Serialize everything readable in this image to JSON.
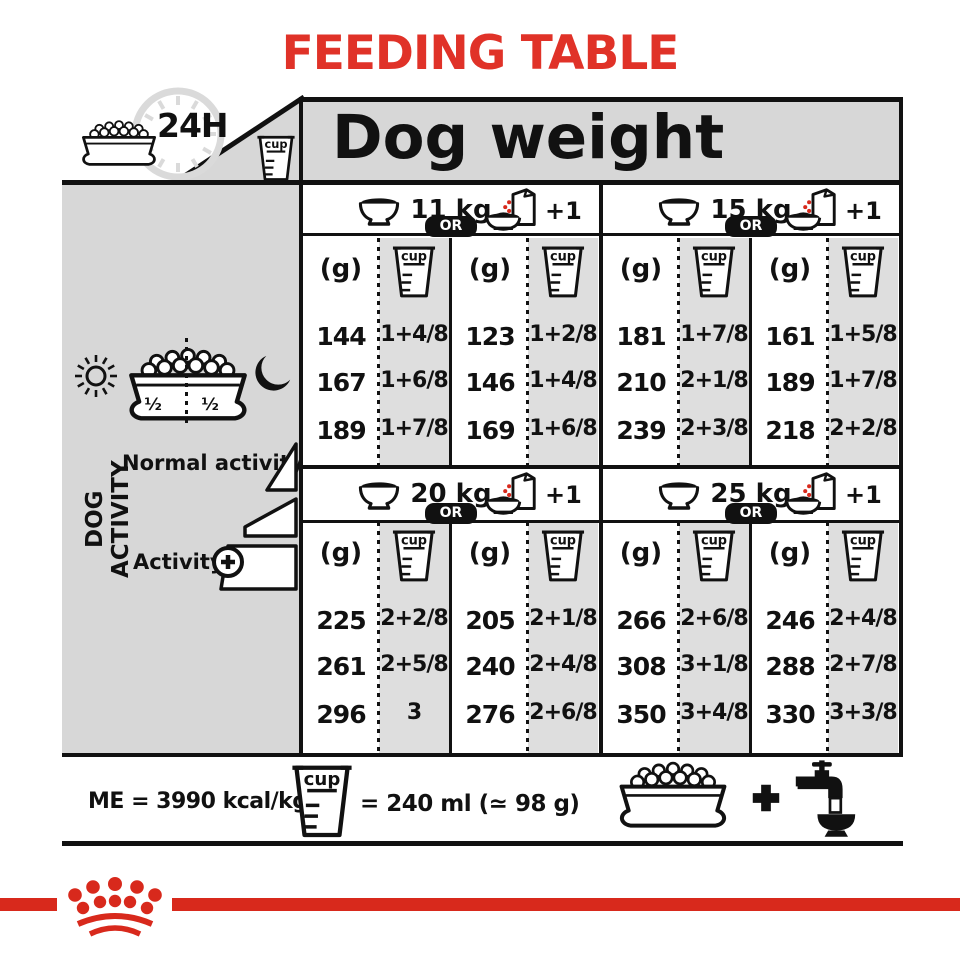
{
  "title": "FEEDING TABLE",
  "colors": {
    "accent_red": "#e03228",
    "crown_red": "#d8291c",
    "panel_gray": "#d7d7d7",
    "cell_gray": "#dedede",
    "ink": "#111111"
  },
  "header": {
    "duration_label": "24H",
    "dog_weight_label": "Dog weight"
  },
  "units": {
    "grams": "(g)",
    "cup": "cup"
  },
  "labels": {
    "or": "OR",
    "plus_one": "+1"
  },
  "sidebar": {
    "axis_label": "DOG ACTIVITY",
    "half_left": "½",
    "half_right": "½",
    "normal_activity": "Normal activity",
    "activity": "Activity"
  },
  "weights": [
    {
      "label": "11 kg",
      "bowl_g": [
        "144",
        "167",
        "189"
      ],
      "bowl_cup": [
        "1+4/8",
        "1+6/8",
        "1+7/8"
      ],
      "pouch_g": [
        "123",
        "146",
        "169"
      ],
      "pouch_cup": [
        "1+2/8",
        "1+4/8",
        "1+6/8"
      ]
    },
    {
      "label": "15 kg",
      "bowl_g": [
        "181",
        "210",
        "239"
      ],
      "bowl_cup": [
        "1+7/8",
        "2+1/8",
        "2+3/8"
      ],
      "pouch_g": [
        "161",
        "189",
        "218"
      ],
      "pouch_cup": [
        "1+5/8",
        "1+7/8",
        "2+2/8"
      ]
    },
    {
      "label": "20 kg",
      "bowl_g": [
        "225",
        "261",
        "296"
      ],
      "bowl_cup": [
        "2+2/8",
        "2+5/8",
        "3"
      ],
      "pouch_g": [
        "205",
        "240",
        "276"
      ],
      "pouch_cup": [
        "2+1/8",
        "2+4/8",
        "2+6/8"
      ]
    },
    {
      "label": "25 kg",
      "bowl_g": [
        "266",
        "308",
        "350"
      ],
      "bowl_cup": [
        "2+6/8",
        "3+1/8",
        "3+4/8"
      ],
      "pouch_g": [
        "246",
        "288",
        "330"
      ],
      "pouch_cup": [
        "2+4/8",
        "2+7/8",
        "3+3/8"
      ]
    }
  ],
  "footer": {
    "me_label": "ME = 3990 kcal/kg",
    "cup_equiv_label": "= 240 ml (≃ 98 g)"
  }
}
